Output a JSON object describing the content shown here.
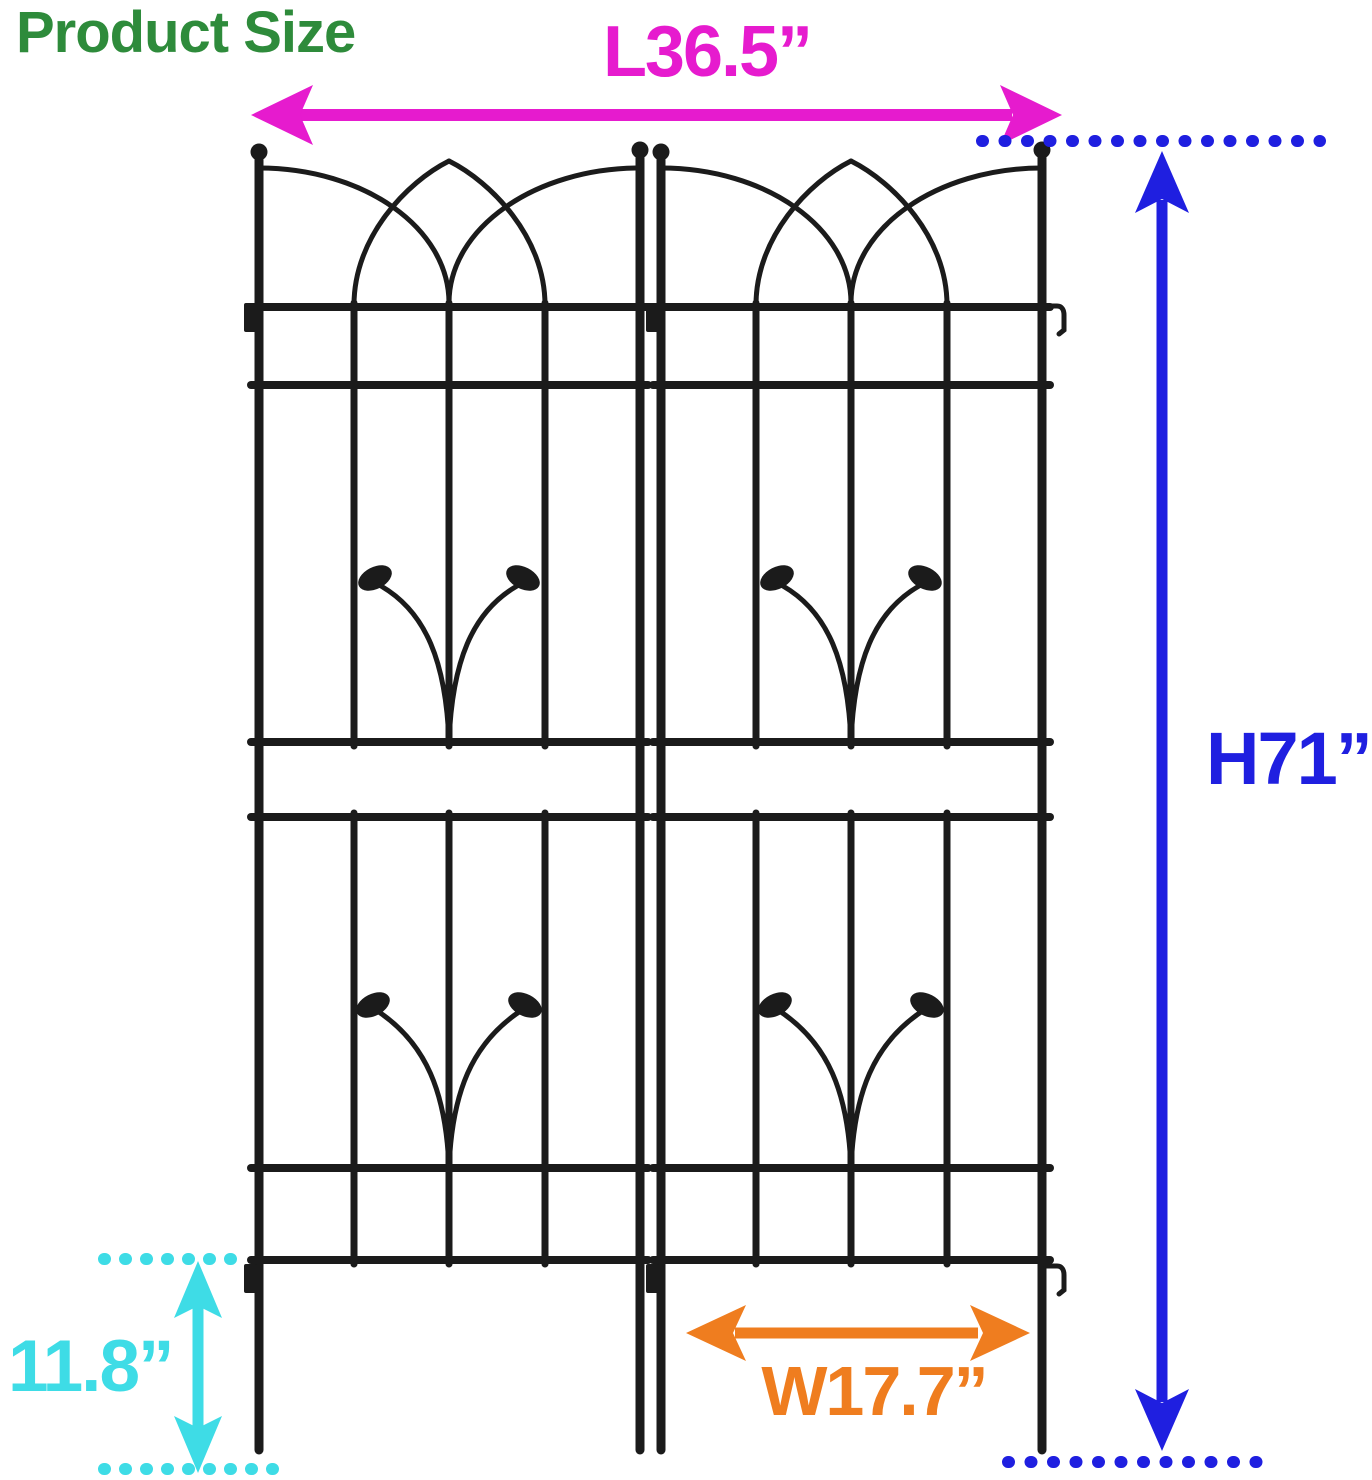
{
  "title": "Product Size",
  "dimensions": {
    "length": "L36.5”",
    "height": "H71”",
    "stake": "11.8”",
    "width": "W17.7”"
  },
  "trellis": {
    "panel_count": 2
  },
  "colors": {
    "green": "#2E8B3B",
    "magenta": "#E61BCE",
    "blue": "#1F1FE0",
    "cyan": "#3EDCE6",
    "orange": "#EF7D1F",
    "ink": "#1B1B1B",
    "bg": "#FFFFFF"
  }
}
